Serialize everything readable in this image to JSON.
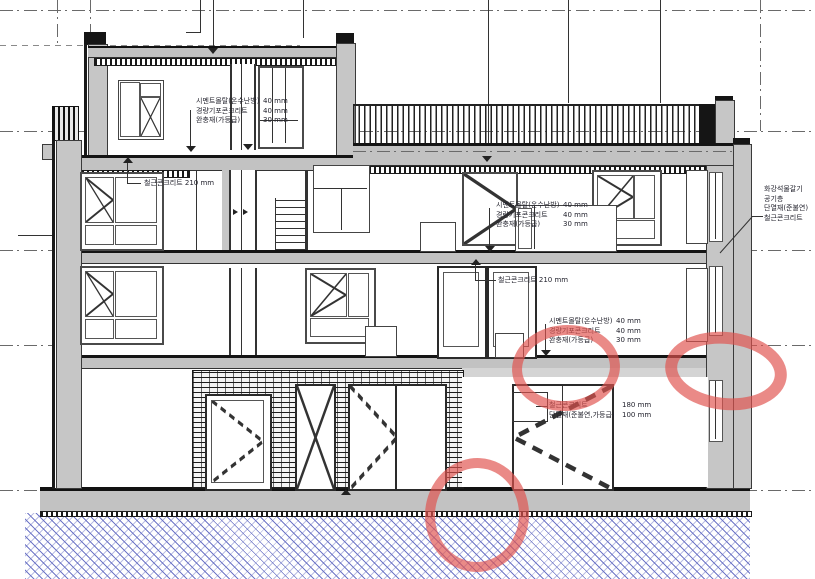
{
  "drawing": {
    "kind": "building cross-section (단면도)",
    "annotations": {
      "floor_spec": {
        "rows": [
          {
            "label": "시멘트몰탈(온수난방)",
            "value": "40 mm"
          },
          {
            "label": "경량기포콘크리트",
            "value": "40 mm"
          },
          {
            "label": "완충재(가등급)",
            "value": "30 mm"
          }
        ]
      },
      "slab_spec_text": "철근콘크리트 210 mm",
      "ground_spec": {
        "rows": [
          {
            "label": "철근콘크리트",
            "value": "180 mm"
          },
          {
            "label": "단열재(준불연,가등급)",
            "value": "100 mm"
          }
        ]
      },
      "wall_spec": {
        "rows": [
          "화강석물갈기",
          "공기층",
          "단열재(준불연)",
          "철근콘크리트"
        ]
      }
    },
    "markup": {
      "color": "#e0534e",
      "circles": [
        "2f-slab-edge-center",
        "2f-slab-edge-right",
        "ground-slab-center"
      ]
    },
    "palette": {
      "earth_hatch": "#6870c4",
      "wall_fill": "#c6c6c6",
      "slab_fill": "#c2c2c2",
      "line": "#1a1a1a"
    }
  }
}
